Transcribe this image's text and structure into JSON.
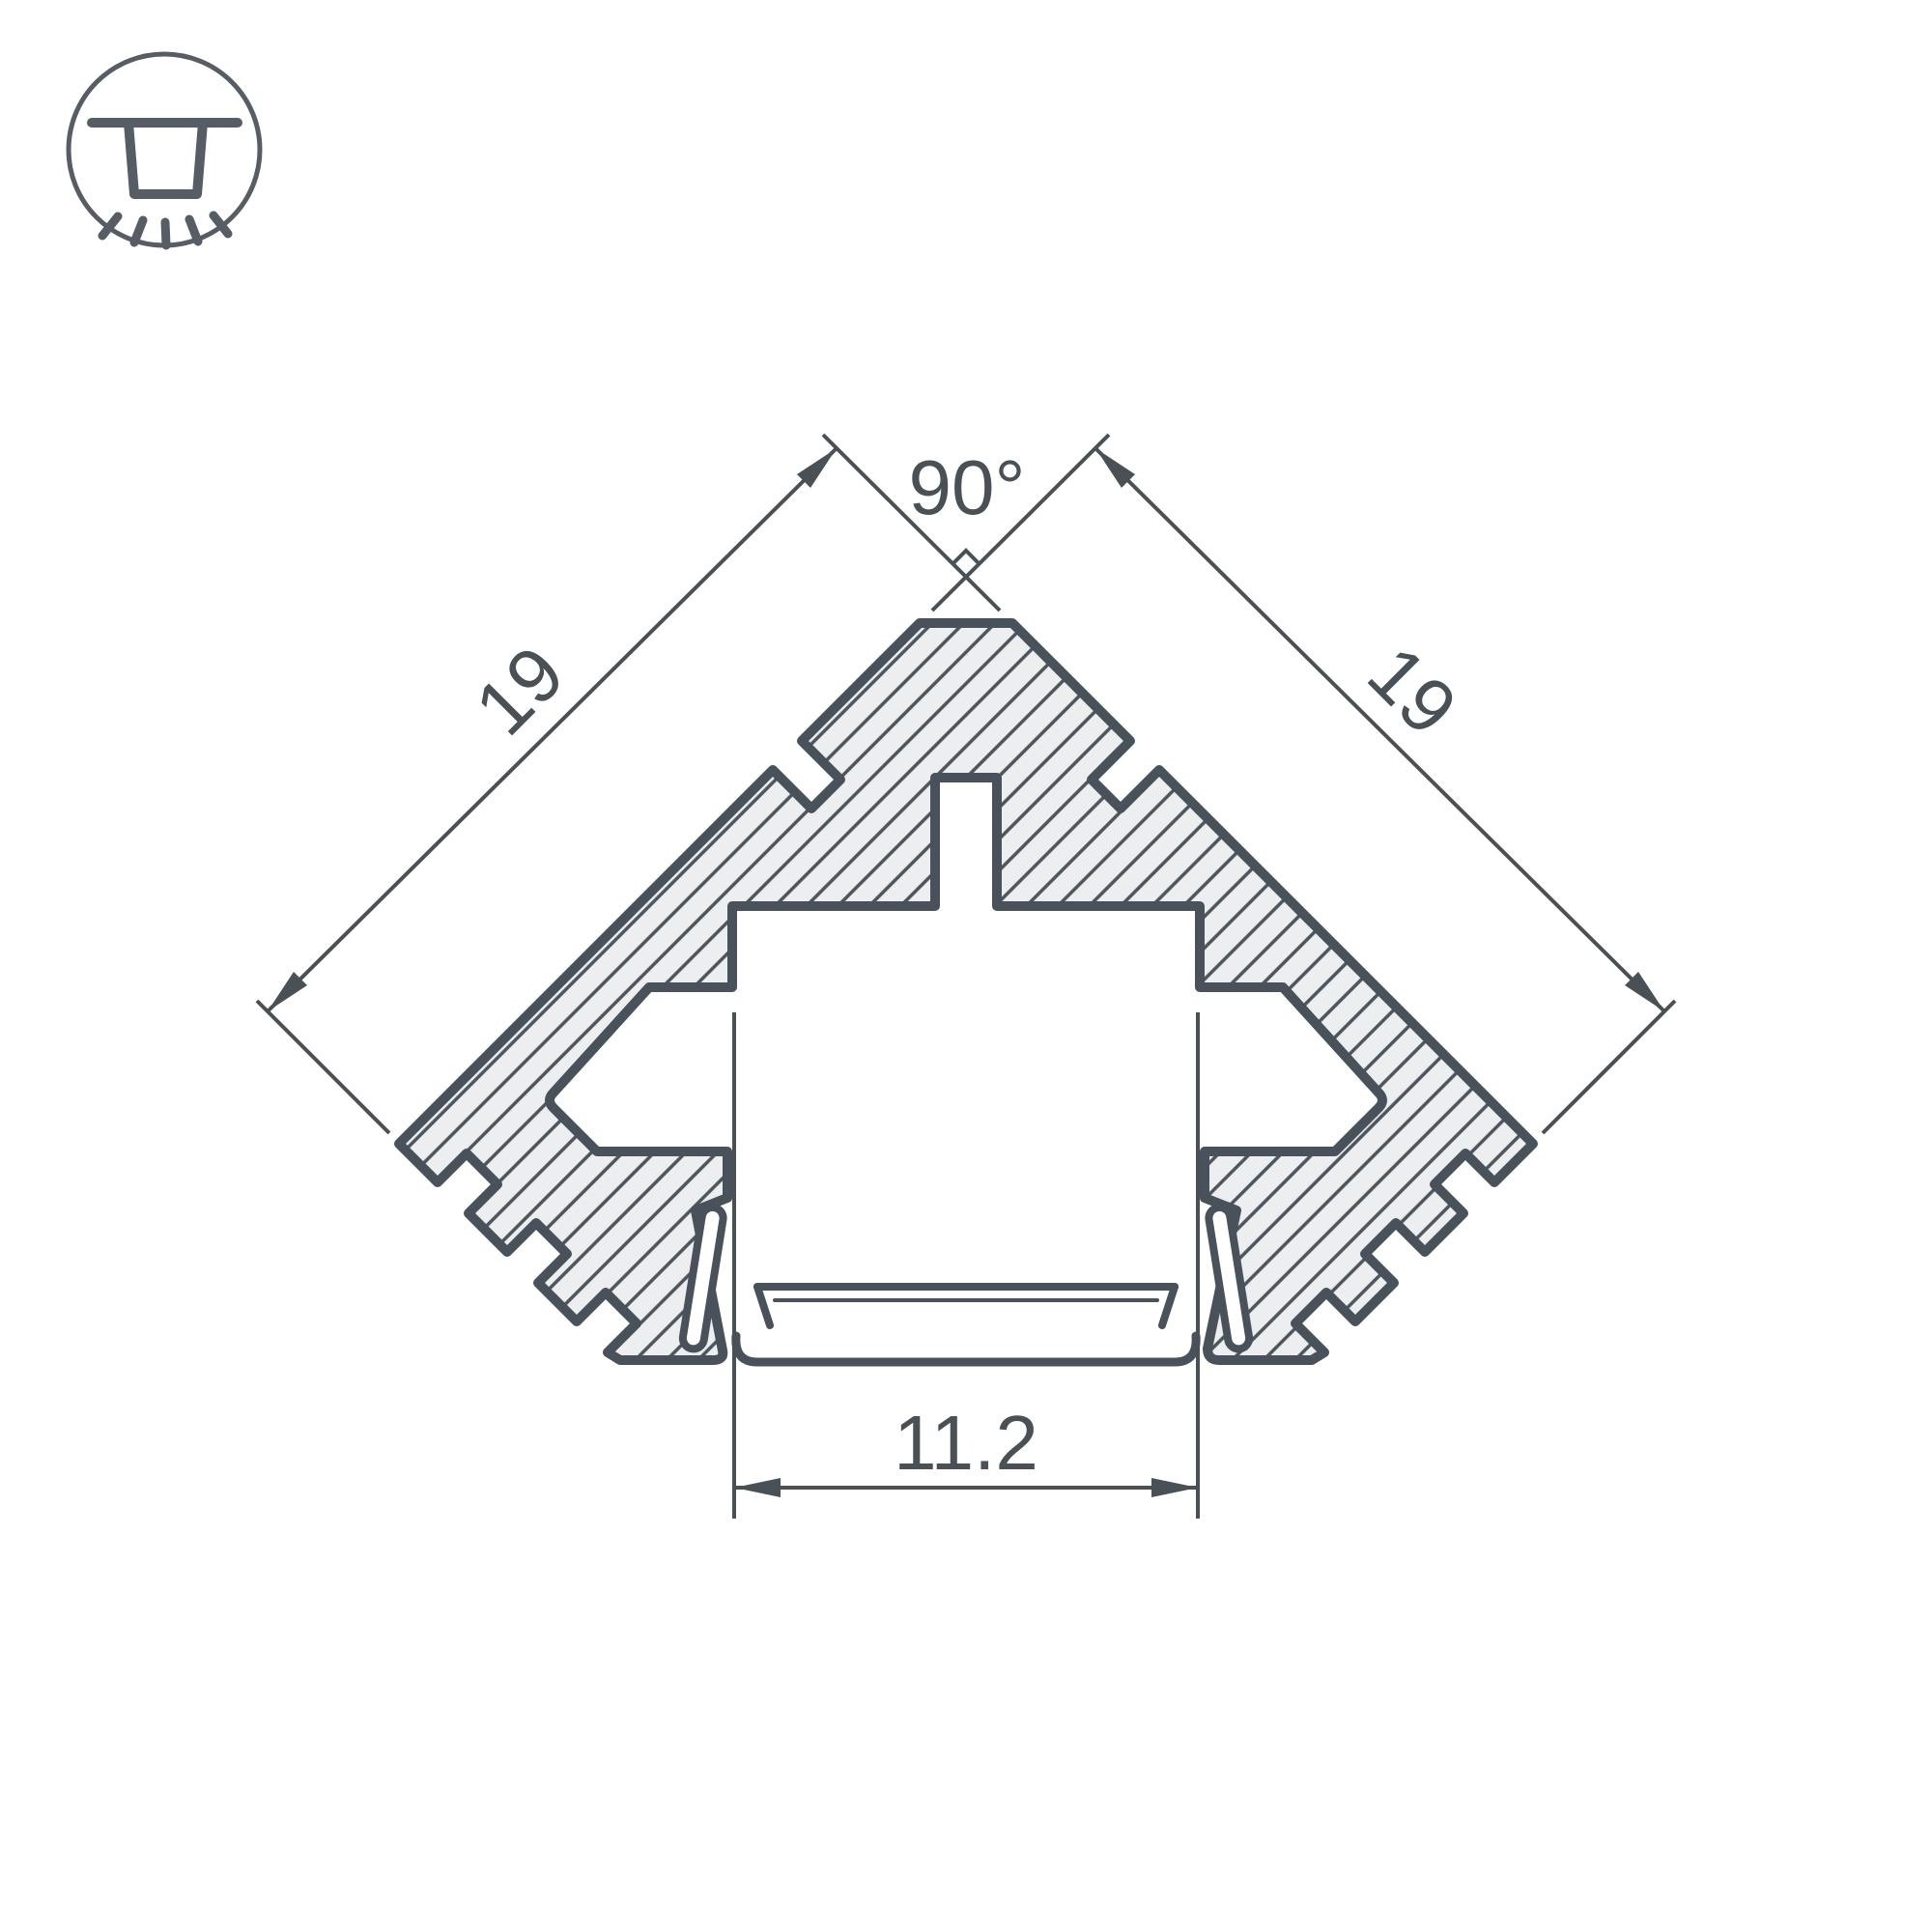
{
  "colors": {
    "background": "#ffffff",
    "outline": "#49515a",
    "hatch_line": "#4d555c",
    "aluminum_fill": "#eceef0",
    "cavity_fill": "#ffffff",
    "text": "#4a5156",
    "icon_stroke": "#565d64"
  },
  "icon": {
    "name": "recessed-ceiling-light"
  },
  "dimensions": {
    "angle": "90°",
    "side_left": "19",
    "side_right": "19",
    "opening_width": "11.2"
  }
}
